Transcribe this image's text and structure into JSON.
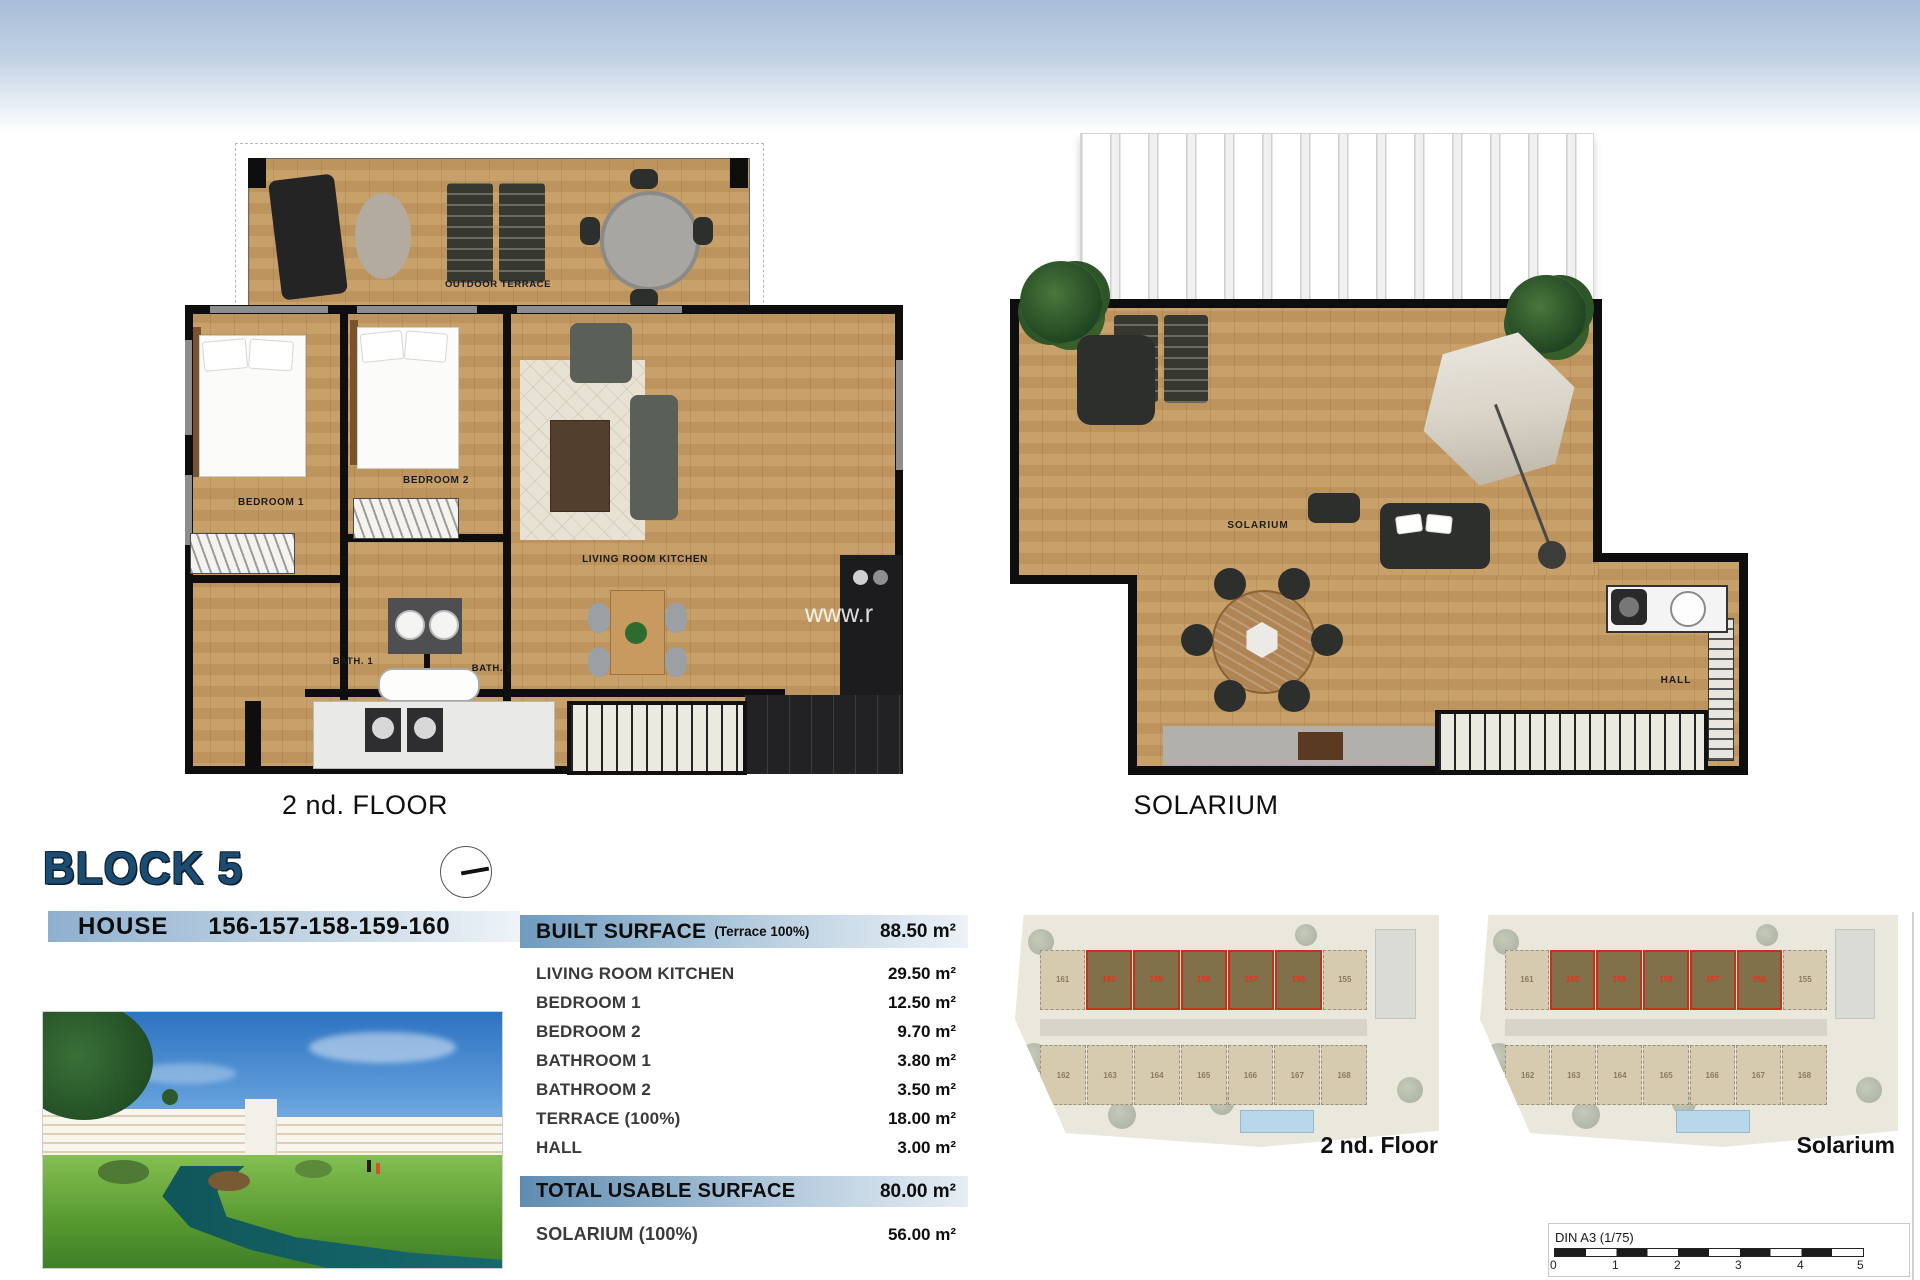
{
  "plans": {
    "second_floor": {
      "caption": "2 nd. FLOOR",
      "rooms": {
        "outdoor_terrace": "OUTDOOR TERRACE",
        "bedroom1": "BEDROOM 1",
        "bedroom2": "BEDROOM 2",
        "living": "LIVING ROOM KITCHEN",
        "bath1": "BATH. 1",
        "bath2": "BATH. 2"
      },
      "watermark": "www.r"
    },
    "solarium": {
      "caption": "SOLARIUM",
      "rooms": {
        "solarium": "SOLARIUM",
        "hall": "HALL"
      }
    }
  },
  "block": {
    "title": "BLOCK 5"
  },
  "house": {
    "label": "HOUSE",
    "numbers": "156-157-158-159-160"
  },
  "surface_table": {
    "built": {
      "label": "BUILT SURFACE",
      "note": "(Terrace 100%)",
      "value": "88.50 m²"
    },
    "rows": [
      {
        "label": "LIVING ROOM KITCHEN",
        "value": "29.50 m²"
      },
      {
        "label": "BEDROOM 1",
        "value": "12.50 m²"
      },
      {
        "label": "BEDROOM 2",
        "value": "9.70 m²"
      },
      {
        "label": "BATHROOM 1",
        "value": "3.80 m²"
      },
      {
        "label": "BATHROOM 2",
        "value": "3.50 m²"
      },
      {
        "label": "TERRACE (100%)",
        "value": "18.00 m²"
      },
      {
        "label": "HALL",
        "value": "3.00 m²"
      }
    ],
    "total": {
      "label": "TOTAL USABLE SURFACE",
      "value": "80.00 m²"
    },
    "solarium": {
      "label": "SOLARIUM (100%)",
      "value": "56.00 m²"
    }
  },
  "site_plans": {
    "left_label": "2 nd. Floor",
    "right_label": "Solarium",
    "top_units": [
      "161",
      "160",
      "159",
      "158",
      "157",
      "156",
      "155"
    ],
    "bottom_units": [
      "162",
      "163",
      "164",
      "165",
      "166",
      "167",
      "168"
    ]
  },
  "scale": {
    "label": "DIN A3 (1/75)",
    "ticks": [
      "0",
      "1",
      "2",
      "3",
      "4",
      "5"
    ]
  },
  "colors": {
    "accent_blue": "#1d4c72",
    "red_highlight": "#c8301c",
    "wood": "#c59a61"
  }
}
